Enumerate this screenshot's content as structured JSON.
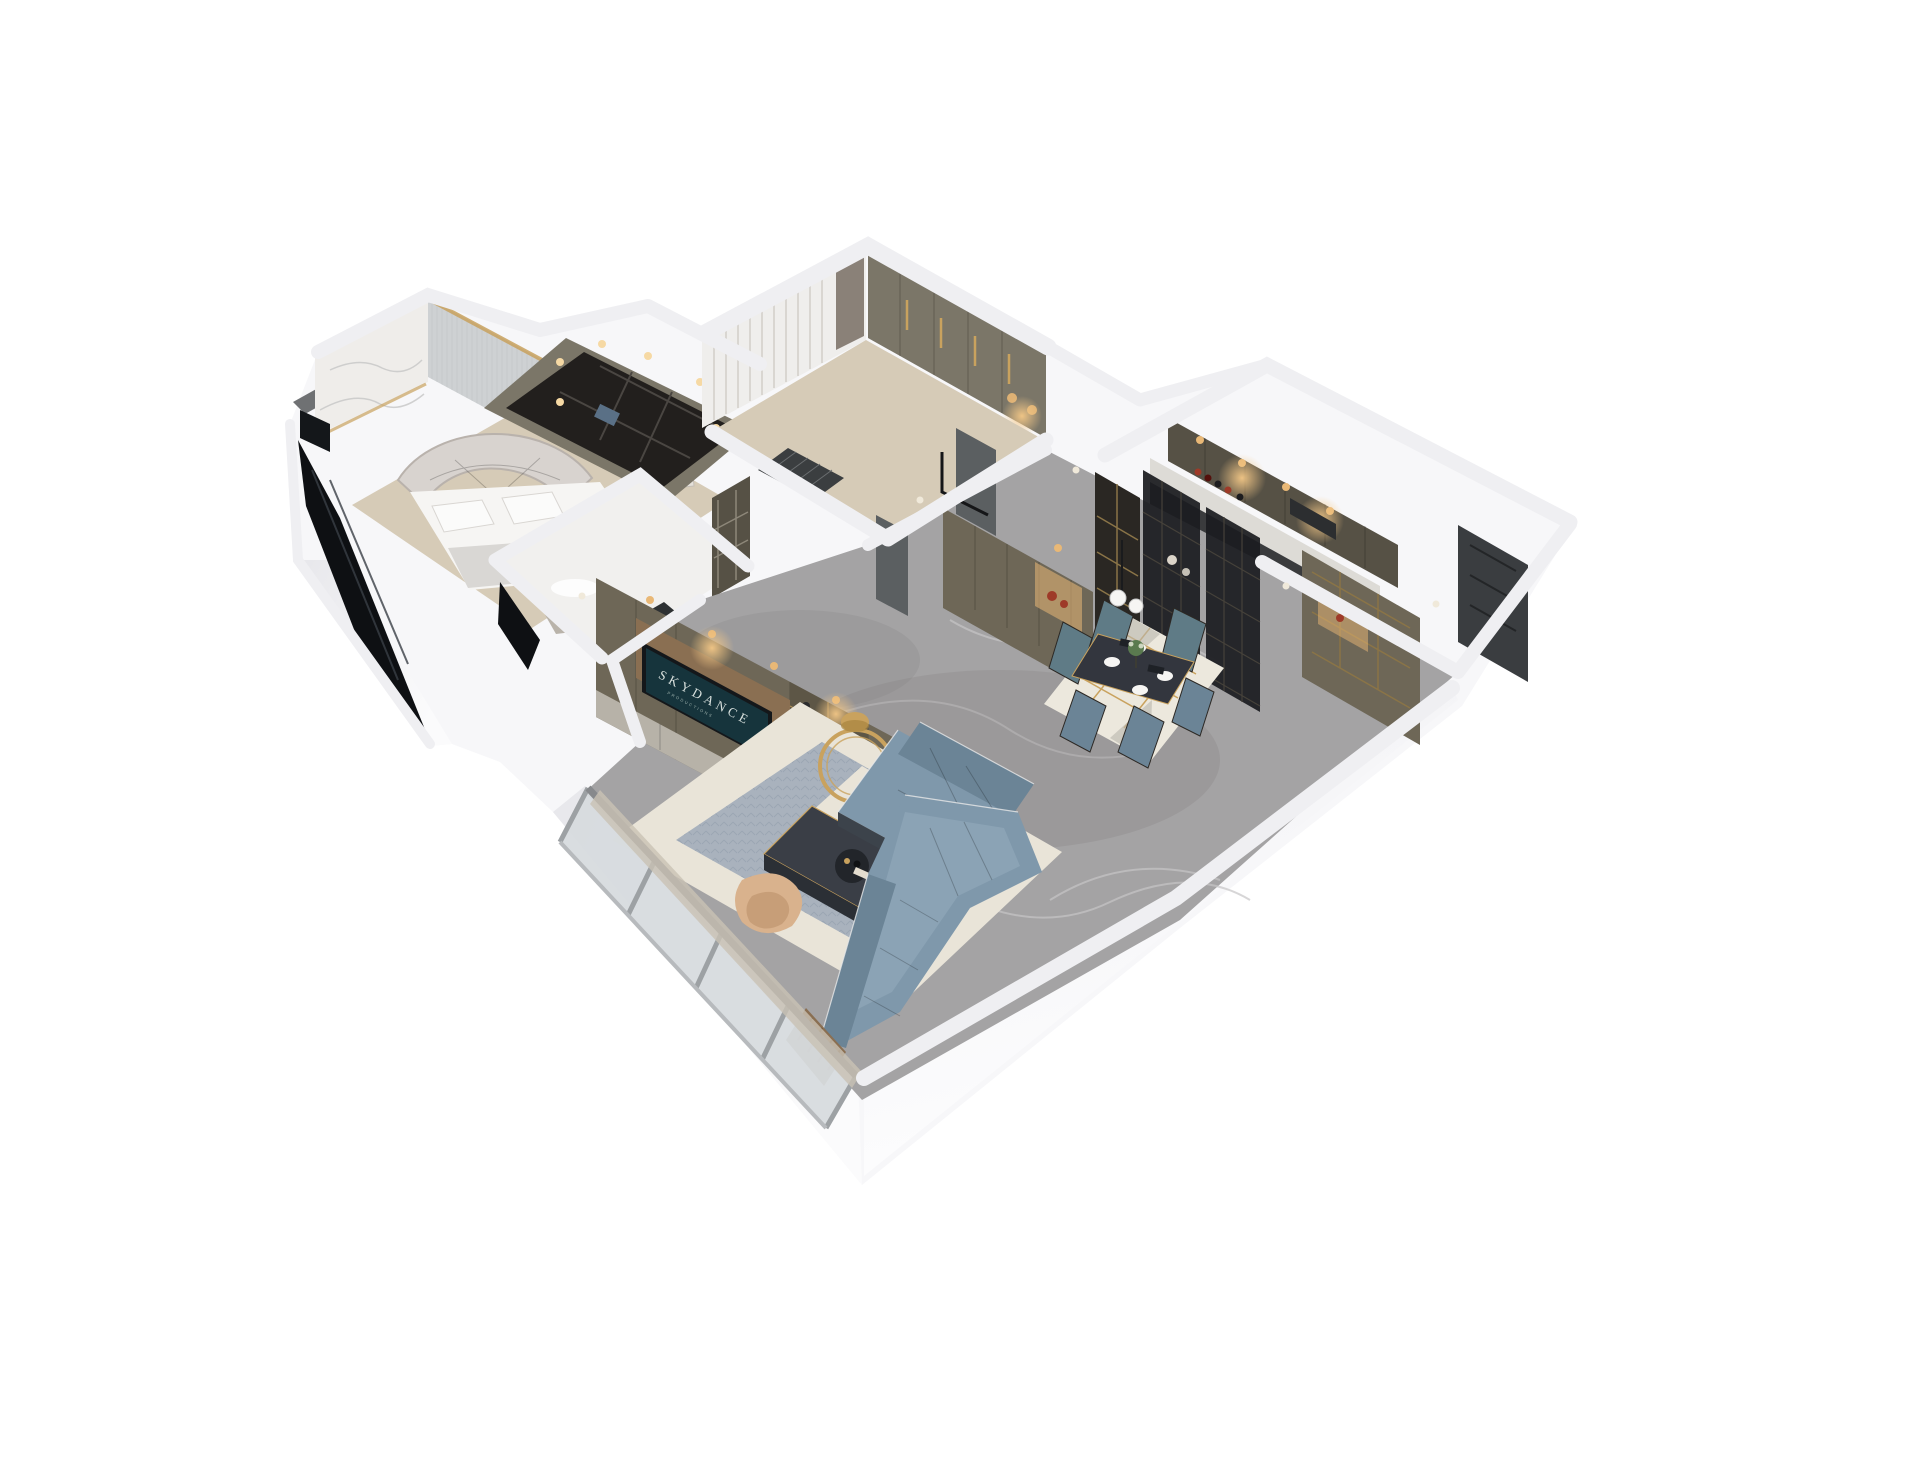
{
  "tv": {
    "line1": "SKYDANCE",
    "line2": "PRODUCTIONS"
  },
  "palette": {
    "background": "#ffffff",
    "wall_white": "#f7f7f9",
    "wall_shade": "#e9e9ed",
    "wall_deep": "#dcdce1",
    "ridge": "#efeff2",
    "ledge_dark": "#6f7173",
    "marble_wall": "#efedea",
    "ribbed_wall": "#ced1d3",
    "floor_wood": "#d6cbb7",
    "floor_white": "#f1f0ee",
    "floor_marble": "#a4a3a4",
    "marble_vein": "#c6c5c6",
    "rug_cream": "#e9e4d8",
    "rug_blue": "#a9b2bd",
    "rug_dining": "#ece8dd",
    "gold": "#c9a25e",
    "warm_light": "#e9b876",
    "cabinet_olive": "#6e6757",
    "cabinet_sage": "#7b7668",
    "cabinet_dark": "#565145",
    "drawer_gray": "#b7b2a8",
    "wood_trim": "#8a6f52",
    "tv_black": "#14171a",
    "tv_screen": "#16343c",
    "sofa_blue": "#7f98ab",
    "sofa_deep": "#6b8496",
    "chair_teal": "#5f7b86",
    "chair_wood": "#35302c",
    "table_dark": "#3a3e46",
    "dine_table": "#33363e",
    "glass_black": "#1b1c20",
    "glass_smoke": "#2a2723",
    "frame_gold": "#8a7447",
    "window_glass": "#d7dbde",
    "window_frame": "#9da1a4",
    "curtain": "#efeeec",
    "curtain_shade": "#d9d6d1",
    "curtain_dark": "#8a8178",
    "door_gray": "#5b5f61",
    "door_dark": "#3a3d40",
    "mat_dark": "#3b3e40",
    "black_glass": "#0e1013",
    "tan_chair": "#d9b28d",
    "plant": "#5a7a4f",
    "red_accent": "#9e3a28",
    "white_decor": "#f6f5f3"
  }
}
